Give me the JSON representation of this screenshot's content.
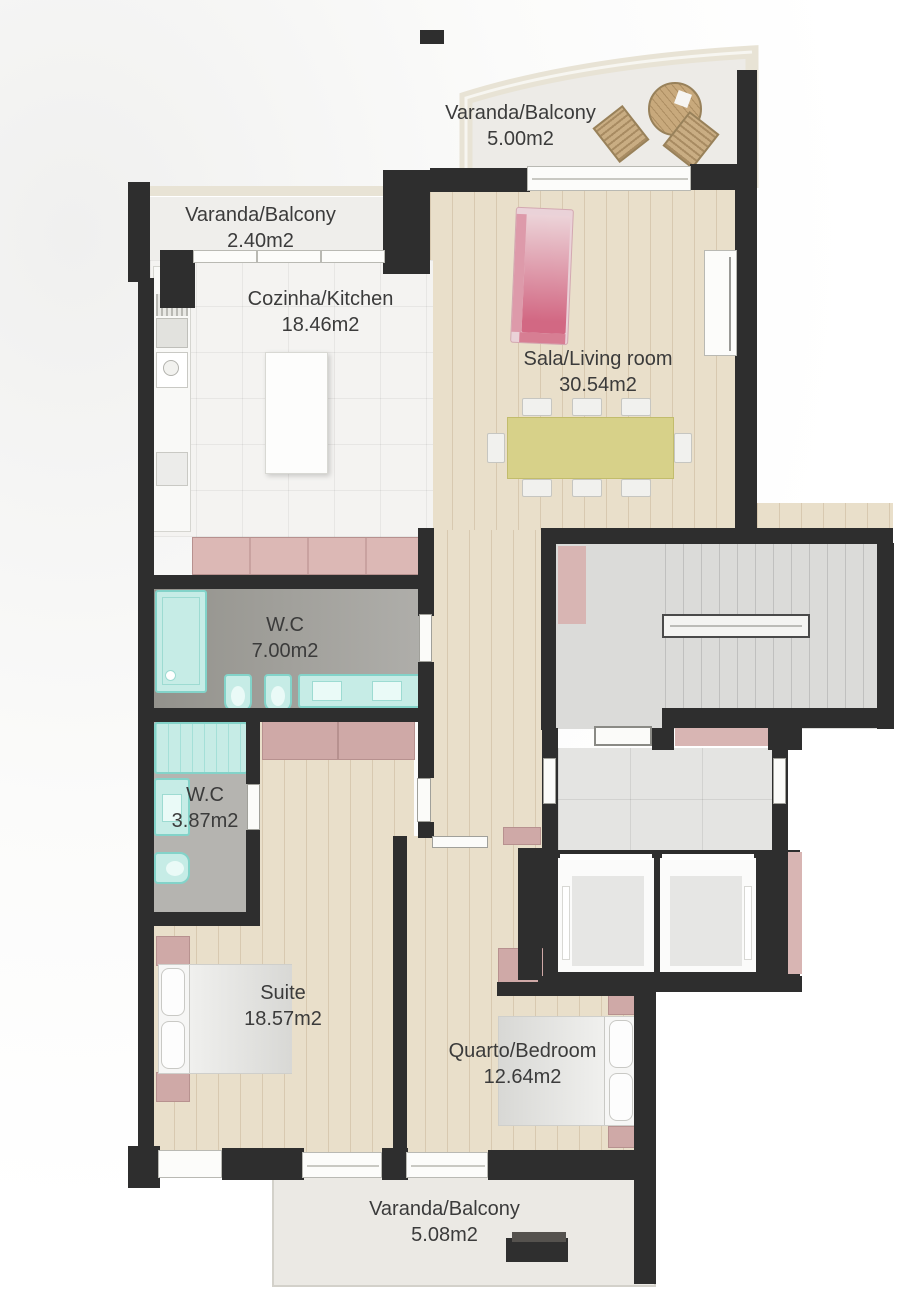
{
  "rooms": {
    "balcony_top": {
      "name": "Varanda/Balcony",
      "area": "5.00m2"
    },
    "balcony_kitchen": {
      "name": "Varanda/Balcony",
      "area": "2.40m2"
    },
    "kitchen": {
      "name": "Cozinha/Kitchen",
      "area": "18.46m2"
    },
    "living_room": {
      "name": "Sala/Living room",
      "area": "30.54m2"
    },
    "wc_main": {
      "name": "W.C",
      "area": "7.00m2"
    },
    "wc_guest": {
      "name": "W.C",
      "area": "3.87m2"
    },
    "suite": {
      "name": "Suite",
      "area": "18.57m2"
    },
    "bedroom": {
      "name": "Quarto/Bedroom",
      "area": "12.64m2"
    },
    "balcony_bottom": {
      "name": "Varanda/Balcony",
      "area": "5.08m2"
    }
  },
  "palette": {
    "wall": "#2e2e2e",
    "wood_floor": "#e9dfca",
    "kitchen_tile": "#f4f3f1",
    "bathroom_floor": "#a5a49f",
    "stair_floor": "#dbdbd9",
    "balcony_floor": "#ebe9e4",
    "accent_pink": "#cfa9a7",
    "sofa_pink": "#d4708a",
    "table_yellow": "#d7d189",
    "fixture_teal": "#c6ece6",
    "label_text": "#3b3b3b"
  }
}
